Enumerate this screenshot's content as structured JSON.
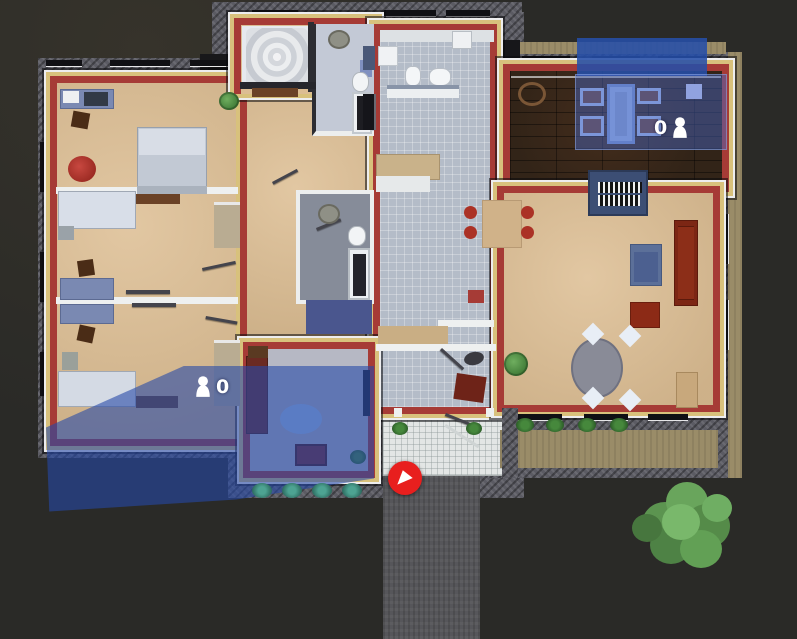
{
  "scene": {
    "description": "top-down house floorplan game view",
    "background": "#2a2a27"
  },
  "zones": [
    {
      "name": "upper-room-zone",
      "occupants": "0",
      "icon": "person-icon",
      "color": "#2d55b4"
    },
    {
      "name": "lower-room-zone",
      "occupants": "0",
      "icon": "person-icon",
      "color": "#2d55b4"
    }
  ],
  "marker": {
    "name": "entrance-marker",
    "icon": "triangle-arrow-icon",
    "color": "#e8201d"
  },
  "icons": {
    "person_icon": "person-silhouette",
    "marker_icon": "triangle-arrow"
  },
  "palette": {
    "zone_blue": "#2d55b4",
    "marker_red": "#e8201d",
    "wall_red": "#a63b36",
    "trim_cream": "#d8c17c",
    "stone": "#5b5b63",
    "floor_tan": "#ddbe93",
    "floor_tile": "#b4bcc8",
    "floor_wood": "#322418",
    "porch": "#e3e6e5",
    "driveway": "#56565a",
    "bush_green": "#5c9450"
  }
}
